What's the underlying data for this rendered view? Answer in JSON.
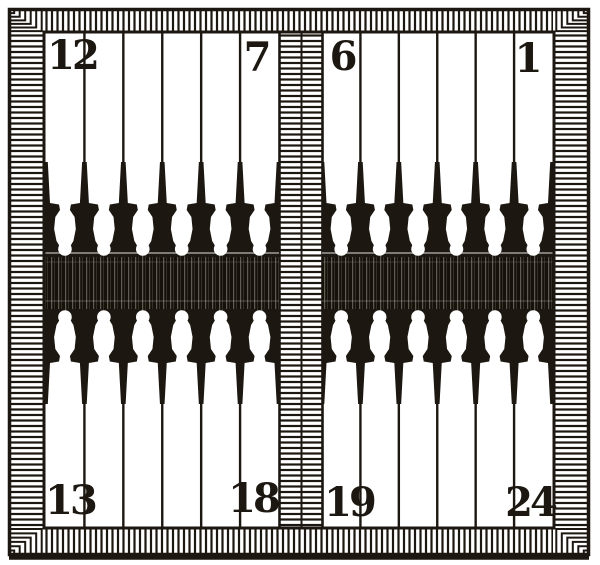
{
  "figure": {
    "medium": "engraved book plate",
    "subject": "backgammon (tables) board with twenty-four numbered points, hatched frame and central hinge bar",
    "ink_color": "#1c1710",
    "paper_color": "#ffffff",
    "band_color": "#171209"
  },
  "board": {
    "points_per_quadrant": 6,
    "point_range": "1-24",
    "tables": [
      {
        "side": "left",
        "top_corner_numbers": [
          "12",
          "7"
        ],
        "bottom_corner_numbers": [
          "13",
          "18"
        ]
      },
      {
        "side": "right",
        "top_corner_numbers": [
          "6",
          "1"
        ],
        "bottom_corner_numbers": [
          "19",
          "24"
        ]
      }
    ]
  },
  "labels": {
    "p12": "12",
    "p7": "7",
    "p6": "6",
    "p1": "1",
    "p13": "13",
    "p18": "18",
    "p19": "19",
    "p24": "24"
  }
}
